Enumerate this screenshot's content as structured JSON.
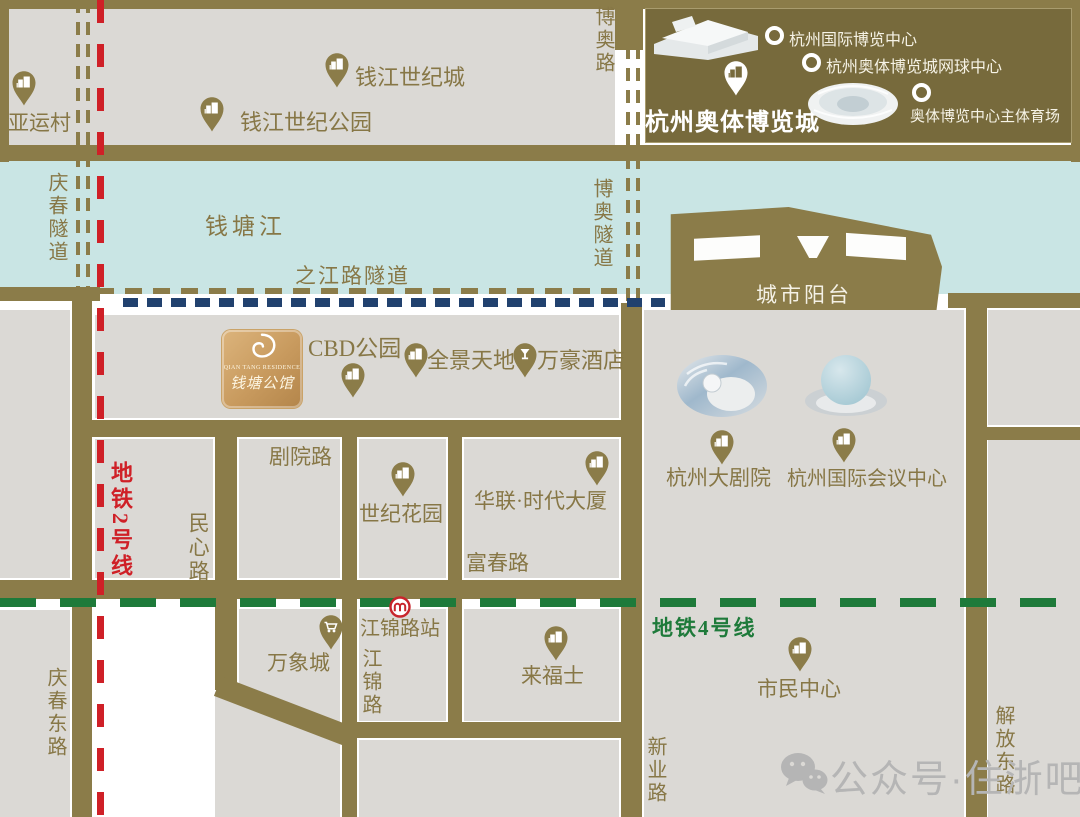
{
  "project": {
    "name_cn": "钱塘公馆",
    "name_en": "QIAN TANG RESIDENCE"
  },
  "legend": {
    "title": "杭州奥体博览城",
    "items": [
      {
        "label": "杭州国际博览中心"
      },
      {
        "label": "杭州奥体博览城网球中心"
      },
      {
        "label": "奥体博览中心主体育场"
      }
    ]
  },
  "river": {
    "name": "钱塘江"
  },
  "tunnels": {
    "qingchun": "庆春隧道",
    "boao": "博奥隧道",
    "zhijiang": "之江路隧道"
  },
  "roads": {
    "boao": "博奥路",
    "juyuan": "剧院路",
    "minxin": "民心路",
    "fuchun": "富春路",
    "jiangjin": "江锦路",
    "qingchundong": "庆春东路",
    "xinye": "新业路",
    "jiefangdong": "解放东路"
  },
  "metro": {
    "line2": "地铁2号线",
    "line4": "地铁4号线",
    "station_jiangjin": "江锦路站"
  },
  "pois": {
    "yayuncun": "亚运村",
    "qianjiang_century_city": "钱江世纪城",
    "qianjiang_century_park": "钱江世纪公园",
    "city_balcony": "城市阳台",
    "cbd_park": "CBD公园",
    "panorama": "全景天地",
    "marriott": "万豪酒店",
    "century_garden": "世纪花园",
    "hualian": "华联·时代大厦",
    "grand_theatre": "杭州大剧院",
    "intl_conference_center": "杭州国际会议中心",
    "mixc": "万象城",
    "raffles": "来福士",
    "civic_center": "市民中心"
  },
  "watermark": {
    "account": "公众号·住浙吧"
  },
  "colors": {
    "road": "#8b7c49",
    "block": "#dbd9d5",
    "river": "#c9e5e4",
    "legend_bg": "#776a3c",
    "metro2_red": "#cf2027",
    "metro4_green": "#1e7a3a",
    "tunnel_blue": "#21416e",
    "label_olive": "#877746",
    "gold_box": "#c89a5e",
    "watermark_gray": "#b5b5b5"
  }
}
